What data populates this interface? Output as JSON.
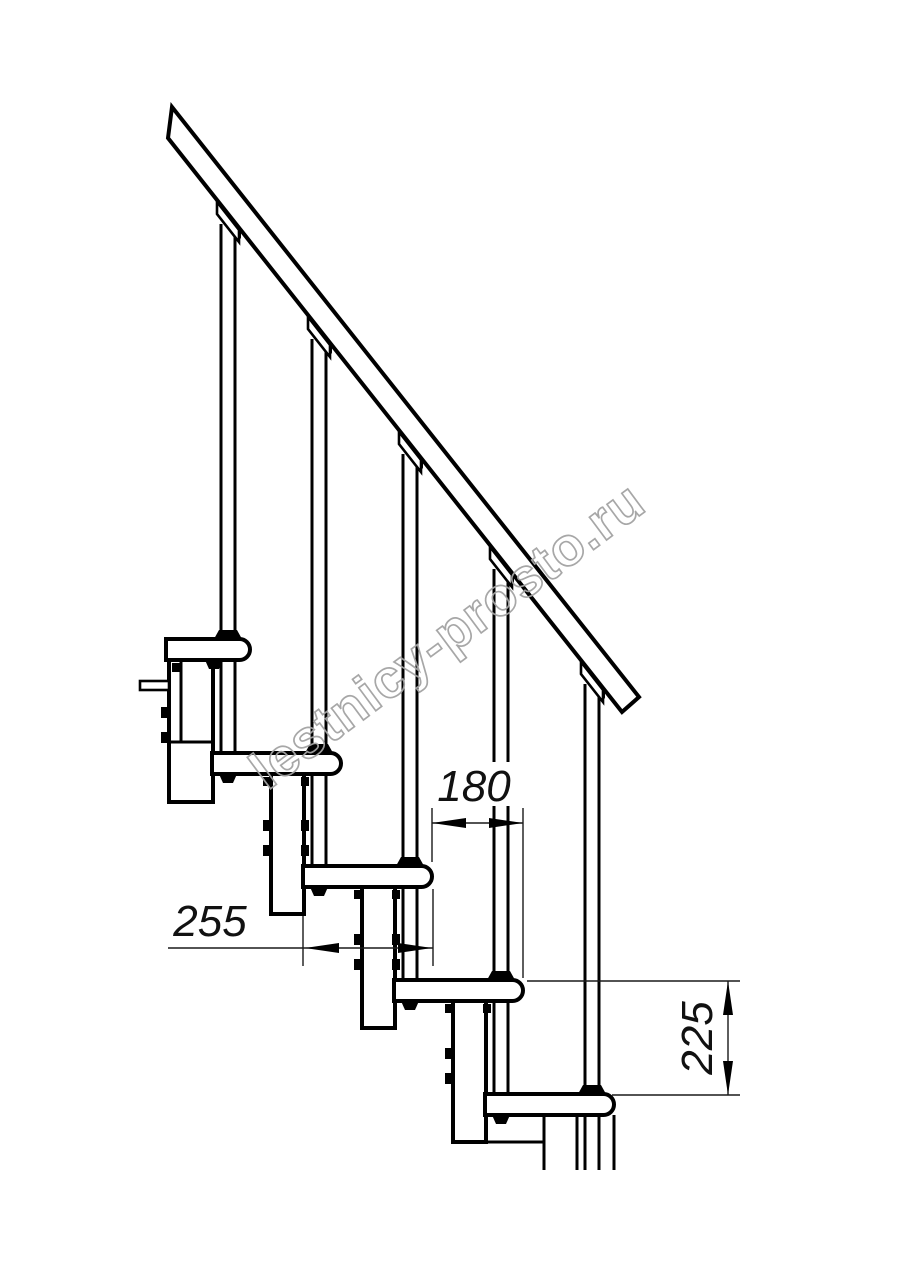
{
  "drawing": {
    "title": "modular-staircase-side-view",
    "dimensions": {
      "tread_depth_mm": "255",
      "step_run_mm": "180",
      "step_rise_mm": "225"
    },
    "watermark": "lestnicy-prosto.ru",
    "colors": {
      "line": "#000000",
      "dimension": "#1a1a1a",
      "watermark": "#a3a3a3",
      "background": "#ffffff"
    },
    "parts": {
      "handrail": "diagonal handrail",
      "balusters": "5 vertical baluster pipes",
      "treads": "5 overlapping treads stepping down left to right",
      "modules": "vertical stringer modules with bolt tabs"
    }
  }
}
